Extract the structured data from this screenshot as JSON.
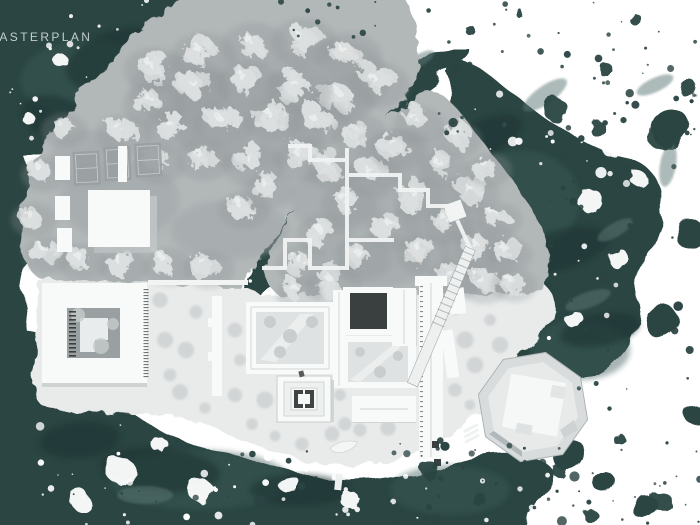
{
  "title": {
    "label": "MASTERPLAN"
  },
  "palette": {
    "paper": "#ffffff",
    "ink": "#2b4443",
    "ink_dark": "#1d3332",
    "ink_mid": "#3d5b59",
    "ink_light": "#5b7775",
    "land": "#b2b7b8",
    "land_shade": "#a0a6a8",
    "tree": "#dcdfdf",
    "tree_hi": "#eef0f0",
    "tree_shadow": "#8e9496",
    "plaza": "#e9ebeb",
    "plaza_dot": "#b6bbbd",
    "building": "#f8f9f9",
    "building_shadow": "#c2c7c8",
    "courtyard": "#9aa0a2",
    "courtyard_light": "#dfe2e2",
    "dark_court": "#3a4040",
    "hatch": "#2a2f2f",
    "path_white": "#f2f4f4",
    "title_color": "#c2cdcd"
  },
  "map": {
    "kind": "architectural-masterplan"
  }
}
